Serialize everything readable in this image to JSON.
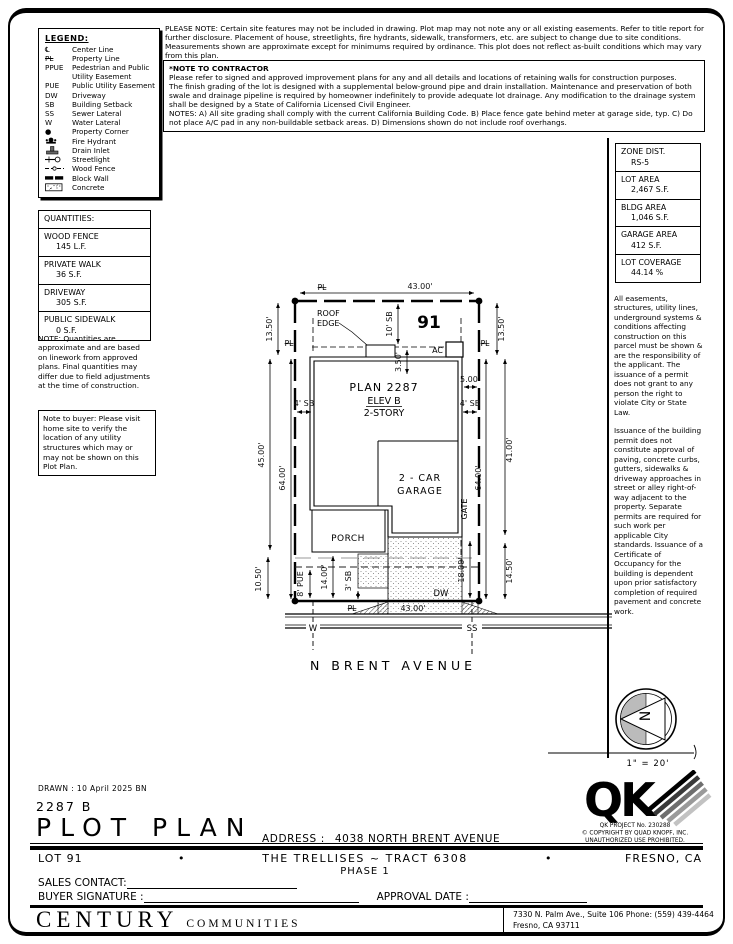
{
  "page": {
    "drawn": "DRAWN :  10 April 2025   BN",
    "plan_number": "2287 B",
    "title": "PLOT PLAN",
    "address_label": "ADDRESS :",
    "address": "4038 NORTH BRENT AVENUE"
  },
  "legend": {
    "title": "LEGEND:",
    "items": [
      {
        "abbr": "℄",
        "label": "Center Line"
      },
      {
        "abbr": "PL",
        "label": "Property Line"
      },
      {
        "abbr": "PPUE",
        "label": "Pedestrian and Public Utility Easement"
      },
      {
        "abbr": "PUE",
        "label": "Public Utility Easement"
      },
      {
        "abbr": "DW",
        "label": "Driveway"
      },
      {
        "abbr": "SB",
        "label": "Building Setback"
      },
      {
        "abbr": "SS",
        "label": "Sewer Lateral"
      },
      {
        "abbr": "W",
        "label": "Water Lateral"
      },
      {
        "abbr": "●",
        "label": "Property Corner",
        "icon": "property-corner"
      },
      {
        "abbr": "",
        "label": "Fire Hydrant",
        "icon": "fire-hydrant"
      },
      {
        "abbr": "",
        "label": "Drain Inlet",
        "icon": "drain-inlet"
      },
      {
        "abbr": "",
        "label": "Streetlight",
        "icon": "streetlight"
      },
      {
        "abbr": "",
        "label": "Wood Fence",
        "icon": "wood-fence"
      },
      {
        "abbr": "",
        "label": "Block Wall",
        "icon": "block-wall"
      },
      {
        "abbr": "",
        "label": "Concrete",
        "icon": "concrete"
      }
    ]
  },
  "top_notes": {
    "please_note": "PLEASE NOTE:  Certain site features may not be included in drawing.  Plot map may not note any or all existing easements.  Refer to title report for further disclosure.  Placement of house, streetlights, fire hydrants, sidewalk, transformers, etc. are subject to change due to site conditions.  Measurements shown are approximate except for minimums required by ordinance.  This plot does not reflect as-built conditions which may vary from this plan.",
    "contractor_title": "*NOTE TO CONTRACTOR",
    "contractor_p1": "Please refer to signed and approved improvement plans for any and all details and locations of retaining walls for construction purposes.",
    "contractor_p2": "The finish grading of the lot is designed with a supplemental below-ground pipe and drain installation.  Maintenance and preservation of both swale and drainage pipeline is required by homeowner indefinitely to provide adequate lot drainage.  Any modification to the drainage system shall be designed by a State of California Licensed Civil Engineer.",
    "contractor_p3": "NOTES:  A) All site grading shall comply with the current California Building Code.  B) Place fence gate behind meter at garage side, typ.  C) Do not place A/C pad in any non-buildable setback areas.  D) Dimensions shown do not include roof overhangs."
  },
  "zoning": {
    "items": [
      {
        "label": "ZONE DIST.",
        "value": "RS-5"
      },
      {
        "label": "LOT AREA",
        "value": "2,467 S.F."
      },
      {
        "label": "BLDG AREA",
        "value": "1,046 S.F."
      },
      {
        "label": "GARAGE AREA",
        "value": "412 S.F."
      },
      {
        "label": "LOT COVERAGE",
        "value": "44.14 %"
      }
    ]
  },
  "site_notes": {
    "p1": "All easements, structures, utility lines, underground systems & conditions affecting construction on this parcel must be shown & are the responsibility of the applicant. The issuance of a permit does not grant to any person the right to violate City or State Law.",
    "p2": "Issuance of the building permit does not constitute approval of paving, concrete curbs, gutters, sidewalks & driveway approaches in street or alley right-of-way adjacent to the property. Separate permits are required for such work per applicable City standards. Issuance of a Certificate of Occupancy for the building is dependent upon prior satisfactory completion of required pavement and concrete work."
  },
  "quantities": {
    "title": "QUANTITIES:",
    "items": [
      {
        "label": "WOOD FENCE",
        "value": "145 L.F."
      },
      {
        "label": "PRIVATE WALK",
        "value": "36 S.F."
      },
      {
        "label": "DRIVEWAY",
        "value": "305 S.F."
      },
      {
        "label": "PUBLIC SIDEWALK",
        "value": "0 S.F."
      }
    ],
    "note": "NOTE: Quantities are approximate and are based on linework from approved plans. Final quantities may differ due to field adjustments at the time of construction.",
    "buyer_note": "Note to buyer: Please visit home site to verify the location of any utility structures which may or may not be shown on this Plot Plan."
  },
  "plot": {
    "lot_number": "91",
    "pl": "PL",
    "plan_line1": "PLAN 2287",
    "plan_line2": "ELEV B",
    "plan_line3": "2-STORY",
    "roof_edge_1": "ROOF",
    "roof_edge_2": "EDGE",
    "ac": "AC",
    "garage_1": "2 - CAR",
    "garage_2": "GARAGE",
    "porch": "PORCH",
    "gate": "GATE",
    "dw": "DW",
    "w": "W",
    "ss": "SS",
    "street": "N BRENT AVENUE",
    "dims": {
      "top": "43.00'",
      "bottom": "43.00'",
      "rear_sb": "10' SB",
      "ac_depth": "3.50'",
      "ac_width": "5.00'",
      "sb_left": "4' SB",
      "sb_right": "4' SB",
      "left_top": "13.50'",
      "right_top": "13.50'",
      "left_mid": "45.00'",
      "left_inner": "64.00'",
      "right_mid": "41.00'",
      "right_inner": "64.00'",
      "left_bottom": "10.50'",
      "right_bottom": "14.50'",
      "drive_depth": "18.00'",
      "pue": "8' PUE",
      "front": "14.00'",
      "front_sb": "3' SB"
    }
  },
  "compass": {
    "north": "N",
    "scale": "1\" = 20'"
  },
  "qk": {
    "logo": "QK",
    "project": "QK PROJECT No. 230288",
    "copyright": "©  COPYRIGHT BY QUAD KNOPF, INC.",
    "unauthorized": "UNAUTHORIZED USE PROHIBITED."
  },
  "footer": {
    "lot": "LOT 91",
    "bullet": "•",
    "tract": "THE TRELLISES ~ TRACT 6308",
    "phase": "PHASE 1",
    "city": "FRESNO, CA",
    "sales_label": "SALES CONTACT:",
    "buyer_label": "BUYER SIGNATURE :",
    "approval_label": "APPROVAL DATE :",
    "company_main": "CENTURY",
    "company_sub": "COMMUNITIES",
    "office_line1": "7330 N. Palm Ave., Suite 106    Phone:  (559) 439-4464",
    "office_line2": "Fresno, CA  93711"
  }
}
